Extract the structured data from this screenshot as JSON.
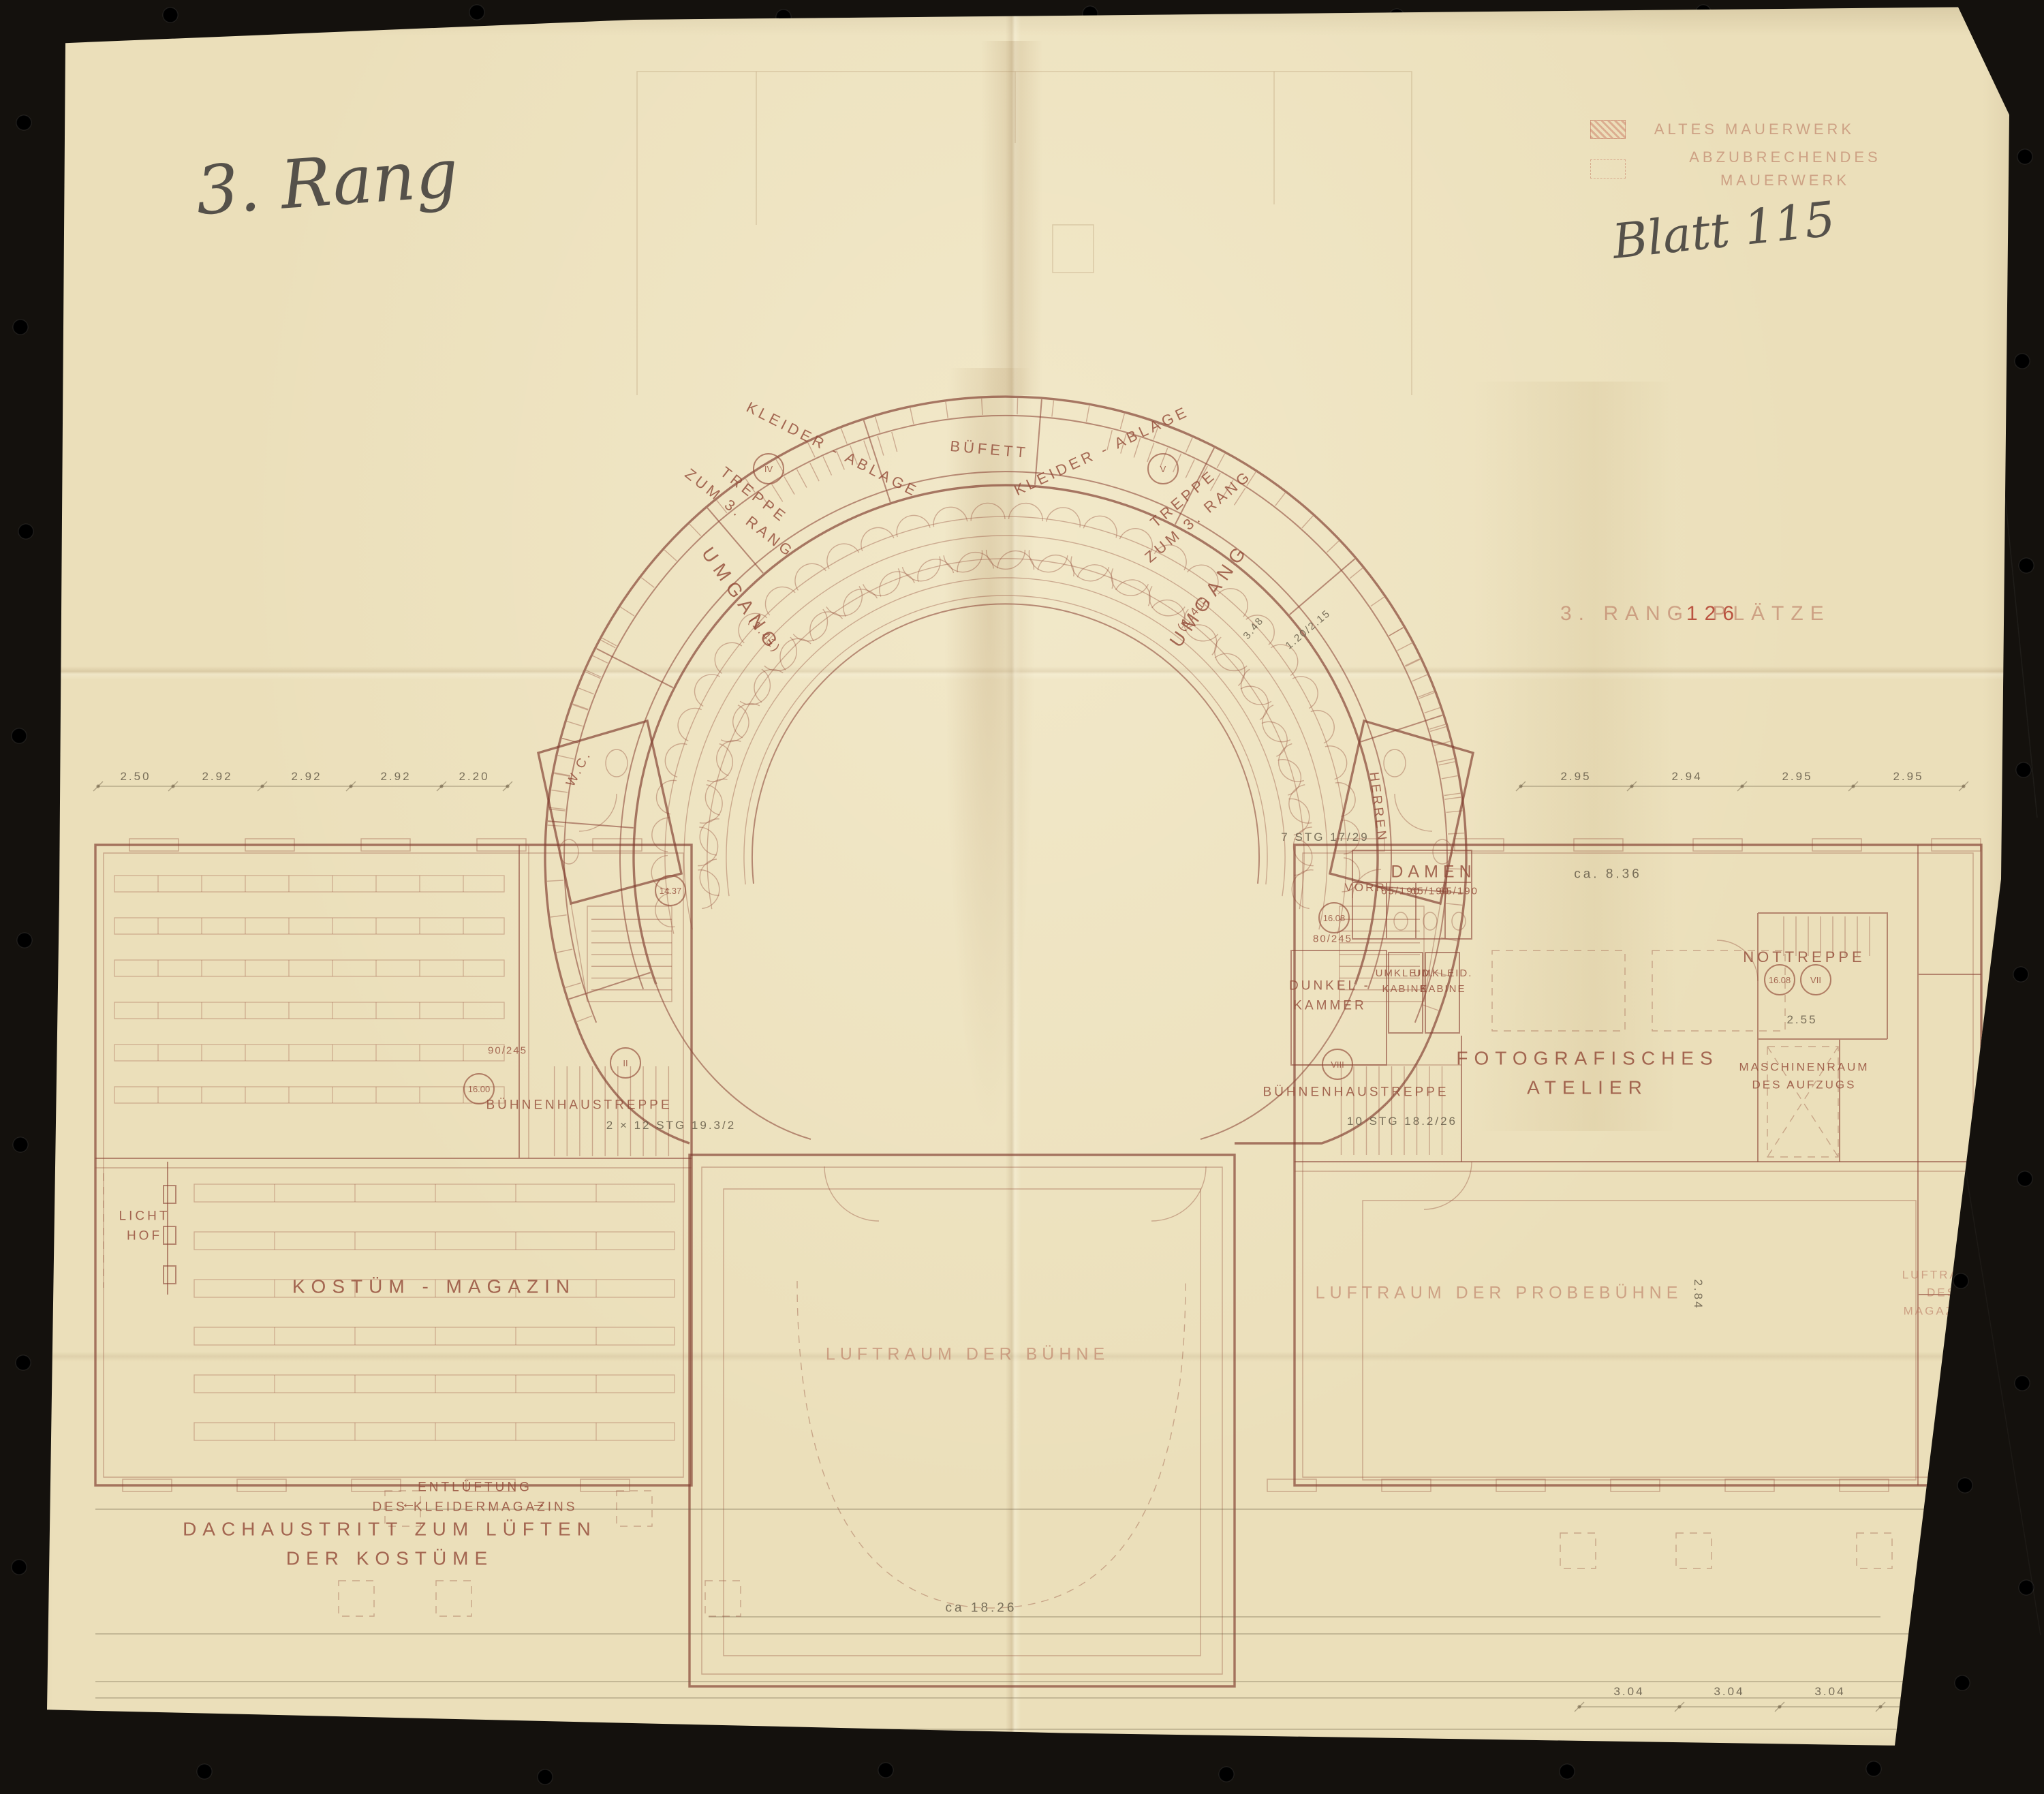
{
  "annotations": {
    "floor_note": "3. Rang",
    "sheet_note": "Blatt 115"
  },
  "legend": {
    "old_masonry": "ALTES MAUERWERK",
    "demolish_masonry": "ABZUBRECHENDES MAUERWERK"
  },
  "caption": {
    "rang": "3. RANG",
    "separator": "·",
    "seats_count": "126",
    "seats_word": "PLÄTZE"
  },
  "plan": {
    "labels": {
      "treppe_left": "TREPPE\nZUM 3. RANG",
      "treppe_right": "TREPPE\nZUM 3. RANG",
      "kleiderablage_left": "KLEIDER - ABLAGE",
      "kleiderablage_right": "KLEIDER - ABLAGE",
      "buefett": "BÜFETT",
      "umgang_left": "UMGANG",
      "umgang_right": "UMGANG",
      "umgang_dim_left": "(1.41)",
      "umgang_dim_right": "(1.41)",
      "wc": "W.C.",
      "herren": "HERREN",
      "damen": "DAMEN",
      "vorraum": "VORR.",
      "umkleide_1": "UMKLEID.\nKABINE",
      "umkleide_2": "UMKLEID.\nKABINE",
      "dunkelkammer": "DUNKEL -\nKAMMER",
      "buehnenhaustreppe_left": "BÜHNENHAUSTREPPE",
      "buehnenhaustreppe_right": "BÜHNENHAUSTREPPE",
      "fotografisches_atelier": "FOTOGRAFISCHES\nATELIER",
      "nottreppe": "NOTTREPPE",
      "maschinenraum": "MASCHINENRAUM\nDES AUFZUGS",
      "kostuem_magazin": "KOSTÜM   -   MAGAZIN",
      "licht_hof": "LICHT\nHOF",
      "luftraum_probebuehne": "LUFTRAUM   DER   PROBEBÜHNE",
      "luftraum_buehne": "LUFTRAUM   DER   BÜHNE",
      "luftraum_magazin": "LUFTRAUM\nDES MAGAZINS",
      "entlueftung": "ENTLÜFTUNG\nDES KLEIDERMAGAZINS",
      "arrow_left": "←",
      "arrow_right": "→",
      "dachaustritt": "DACHAUSTRITT  ZUM  LÜFTEN\nDER  KOSTÜME",
      "stg_7": "7 STG 17/29",
      "stg_10": "10 STG 18.2/26",
      "stg_2x12": "2 × 12 STG 19.3/2"
    },
    "markers": {
      "roman_2": "II",
      "roman_4": "IV",
      "roman_5": "V",
      "roman_7": "VII",
      "roman_8": "VIII",
      "level_1608a": "16.08",
      "level_1608b": "16.08",
      "level_1600": "16.00",
      "level_1437": "14.37"
    },
    "dimensions": {
      "chain_left": [
        "2.50",
        "2.92",
        "2.92",
        "2.92",
        "2.20"
      ],
      "chain_right": [
        "2.95",
        "2.94",
        "2.95",
        "2.95"
      ],
      "chain_bottom": [
        "3.04",
        "3.04",
        "3.04",
        "3.04"
      ],
      "width_corridor": "ca. 8.36",
      "width_stage": "ca 18.26",
      "h_284": "2.84",
      "h_255": "2.55",
      "door_65": "65/190",
      "door_80": "80/245",
      "door_90": "90/245",
      "door_120": "1.20/2.15",
      "d_348": "3.48"
    }
  }
}
